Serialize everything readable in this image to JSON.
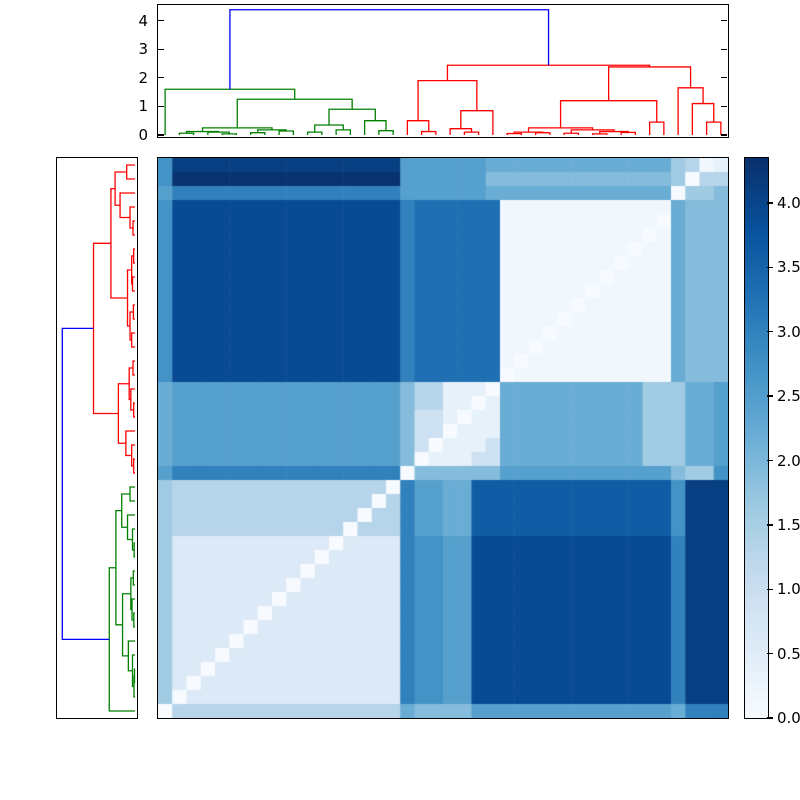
{
  "figure": {
    "background": "#ffffff",
    "description": "Hierarchical clustering heatmap with top and left dendrograms and a Blues colorbar"
  },
  "chart_data": {
    "type": "heatmap",
    "subtype": "clustered-distance-matrix",
    "heatmap": {
      "n_rows": 40,
      "n_cols": 40,
      "vmin": 0,
      "vmax": 4.35,
      "colormap": "Blues",
      "colormap_stops": [
        [
          0.0,
          "#f7fbff"
        ],
        [
          0.125,
          "#deebf7"
        ],
        [
          0.25,
          "#c6dbef"
        ],
        [
          0.375,
          "#9ecae1"
        ],
        [
          0.5,
          "#6baed6"
        ],
        [
          0.625,
          "#4292c6"
        ],
        [
          0.75,
          "#2171b5"
        ],
        [
          0.875,
          "#08519c"
        ],
        [
          1.0,
          "#08306b"
        ]
      ],
      "palette": {
        ".": 0.0,
        "1": 0.15,
        "2": 0.35,
        "3": 0.6,
        "4": 0.9,
        "5": 1.3,
        "6": 1.6,
        "7": 1.9,
        "8": 2.2,
        "9": 2.45,
        "a": 2.7,
        "b": 3.0,
        "c": 3.3,
        "d": 3.6,
        "e": 3.9,
        "f": 4.1,
        "g": 4.3
      },
      "grid": [
        "affffffffffffffff99999988888888888886512",
        "agggggggggggggggg99999977777777777776.55",
        "9bbbbbbbbbbbbbbbb9999998888888888888.667",
        "aeeeeeeeeeeeeeeeebcccccc1111111111118777",
        "aeeeeeeeeeeeeeeeebcccccc11111111111.8777",
        "aeeeeeeeeeeeeeeeebcccccc1111111111.18777",
        "aeeeeeeeeeeeeeeeebcccccc111111111.118777",
        "aeeeeeeeeeeeeeeeebcccccc11111111.1118777",
        "aeeeeeeeeeeeeeeeebcccccc1111111.11118777",
        "aeeeeeeeeeeeeeeeebcccccc111111.111118777",
        "aeeeeeeeeeeeeeeeebcccccc11111.1111118777",
        "aeeeeeeeeeeeeeeeebcccccc1111.11111118777",
        "aeeeeeeeeeeeeeeeebcccccc111.111111118777",
        "aeeeeeeeeeeeeeeeebcccccc11.1111111118777",
        "aeeeeeeeeeeeeeeeebcccccc1.11111111118777",
        "aeeeeeeeeeeeeeeeebcccccc.111111111118777",
        "89999999999999999755222.8888888888666889",
        "8999999999999999975522.28888888888666889",
        "899999999999999997442.228888888888666889",
        "89999999999999999744.2228888888888666889",
        "8999999999999999974.22248888888888666889",
        "899999999999999997.222448888888888666889",
        "9bbbbbbbbbbbbbbbb.777777999999999999766a",
        "6555555555555555.b9988ddddddddddddddafff",
        "655555555555555.5b9988ddddddddddddddafff",
        "65555555555555.55b9988ddddddddddddddafff",
        "6555555555555.555b9988ddddddddddddddafff",
        "633333333333.3333baa99eeeeeeeeeeeeeebfff",
        "63333333333.33333baa99eeeeeeeeeeeeeebfff",
        "6333333333.333333baa99eeeeeeeeeeeeeebfff",
        "633333333.3333333baa99eeeeeeeeeeeeeebfff",
        "63333333.33333333baa99eeeeeeeeeeeeeebfff",
        "6333333.333333333baa99eeeeeeeeeeeeeebfff",
        "633333.3333333333baa99eeeeeeeeeeeeeebfff",
        "63333.33333333333baa99eeeeeeeeeeeeeebfff",
        "6333.333333333333baa99eeeeeeeeeeeeeebfff",
        "633.3333333333333baa99eeeeeeeeeeeeeebfff",
        "63.33333333333333baa99eeeeeeeeeeeeeebfff",
        "6.333333333333333baa99eeeeeeeeeeeeeebfff",
        ".555555555555555587777999999999999998bbb"
      ]
    },
    "top_dendrogram": {
      "orientation": "top",
      "n_leaves": 40,
      "ylim": [
        0,
        4.6
      ],
      "yticks": {
        "values": [
          0,
          1,
          2,
          3,
          4
        ],
        "labels": [
          "0",
          "1",
          "2",
          "3",
          "4"
        ]
      },
      "link_colors": {
        "root": "#0000ff",
        "left_cluster": "#008000",
        "right_cluster": "#ff0000"
      },
      "color_threshold": 3.0,
      "cluster_split_leaf": 17,
      "tree": [
        4.38,
        [
          1.6,
          0,
          [
            1.25,
            [
              0.25,
              [
                0.12,
                [
                  0.06,
                  1,
                  2
                ],
                [
                  0.1,
                  3,
                  [
                    0.04,
                    4,
                    5
                  ]
                ]
              ],
              [
                0.18,
                [
                  0.08,
                  6,
                  7
                ],
                [
                  0.14,
                  8,
                  9
                ]
              ]
            ],
            [
              0.9,
              [
                0.35,
                [
                  0.1,
                  10,
                  11
                ],
                [
                  0.18,
                  12,
                  13
                ]
              ],
              [
                0.5,
                14,
                [
                  0.15,
                  15,
                  16
                ]
              ]
            ]
          ]
        ],
        [
          2.44,
          [
            1.9,
            [
              0.5,
              17,
              [
                0.12,
                18,
                19
              ]
            ],
            [
              0.85,
              [
                0.22,
                20,
                [
                  0.1,
                  21,
                  22
                ]
              ],
              23
            ]
          ],
          [
            2.38,
            [
              1.2,
              [
                0.25,
                [
                  0.1,
                  [
                    0.05,
                    24,
                    25
                  ],
                  [
                    0.08,
                    26,
                    27
                  ]
                ],
                [
                  0.18,
                  [
                    0.06,
                    28,
                    29
                  ],
                  [
                    0.12,
                    [
                      0.04,
                      30,
                      31
                    ],
                    [
                      0.09,
                      32,
                      33
                    ]
                  ]
                ]
              ],
              [
                0.45,
                34,
                35
              ]
            ],
            [
              1.65,
              36,
              [
                1.1,
                37,
                [
                  0.45,
                  38,
                  39
                ]
              ]
            ]
          ]
        ]
      ]
    },
    "left_dendrogram": {
      "orientation": "left",
      "n_leaves": 40,
      "xlim": [
        0,
        4.6
      ],
      "link_colors": {
        "root": "#0000ff",
        "top_cluster": "#ff0000",
        "bottom_cluster": "#008000"
      },
      "color_threshold": 3.0,
      "cluster_split_leaf": 23,
      "tree": [
        4.38,
        [
          2.5,
          [
            1.45,
            [
              1.2,
              [
                0.5,
                0,
                1
              ],
              [
                0.9,
                2,
                [
                  0.3,
                  3,
                  [
                    0.12,
                    4,
                    5
                  ]
                ]
              ]
            ],
            [
              0.45,
              [
                0.2,
                [
                  0.08,
                  6,
                  7
                ],
                [
                  0.15,
                  8,
                  9
                ]
              ],
              [
                0.3,
                [
                  0.1,
                  10,
                  11
                ],
                [
                  0.2,
                  12,
                  13
                ]
              ]
            ]
          ],
          [
            1.0,
            [
              0.35,
              [
                0.12,
                14,
                15
              ],
              [
                0.25,
                16,
                [
                  0.08,
                  17,
                  18
                ]
              ]
            ],
            [
              0.55,
              19,
              [
                0.2,
                20,
                [
                  0.08,
                  21,
                  22
                ]
              ]
            ]
          ]
        ],
        [
          1.55,
          [
            1.15,
            [
              0.8,
              [
                0.3,
                23,
                24
              ],
              [
                0.45,
                25,
                [
                  0.15,
                  26,
                  [
                    0.05,
                    27,
                    28
                  ]
                ]
              ]
            ],
            [
              0.75,
              [
                0.25,
                [
                  0.1,
                  29,
                  30
                ],
                [
                  0.18,
                  31,
                  [
                    0.07,
                    32,
                    33
                  ]
                ]
              ],
              [
                0.4,
                34,
                [
                  0.15,
                  35,
                  [
                    0.06,
                    [
                      0.03,
                      36,
                      37
                    ],
                    38
                  ]
                ]
              ]
            ]
          ],
          39
        ]
      ]
    },
    "colorbar": {
      "vmin": 0.0,
      "vmax": 4.35,
      "ticks": {
        "values": [
          0.0,
          0.5,
          1.0,
          1.5,
          2.0,
          2.5,
          3.0,
          3.5,
          4.0
        ],
        "labels": [
          "0.0",
          "0.5",
          "1.0",
          "1.5",
          "2.0",
          "2.5",
          "3.0",
          "3.5",
          "4.0"
        ]
      }
    }
  }
}
